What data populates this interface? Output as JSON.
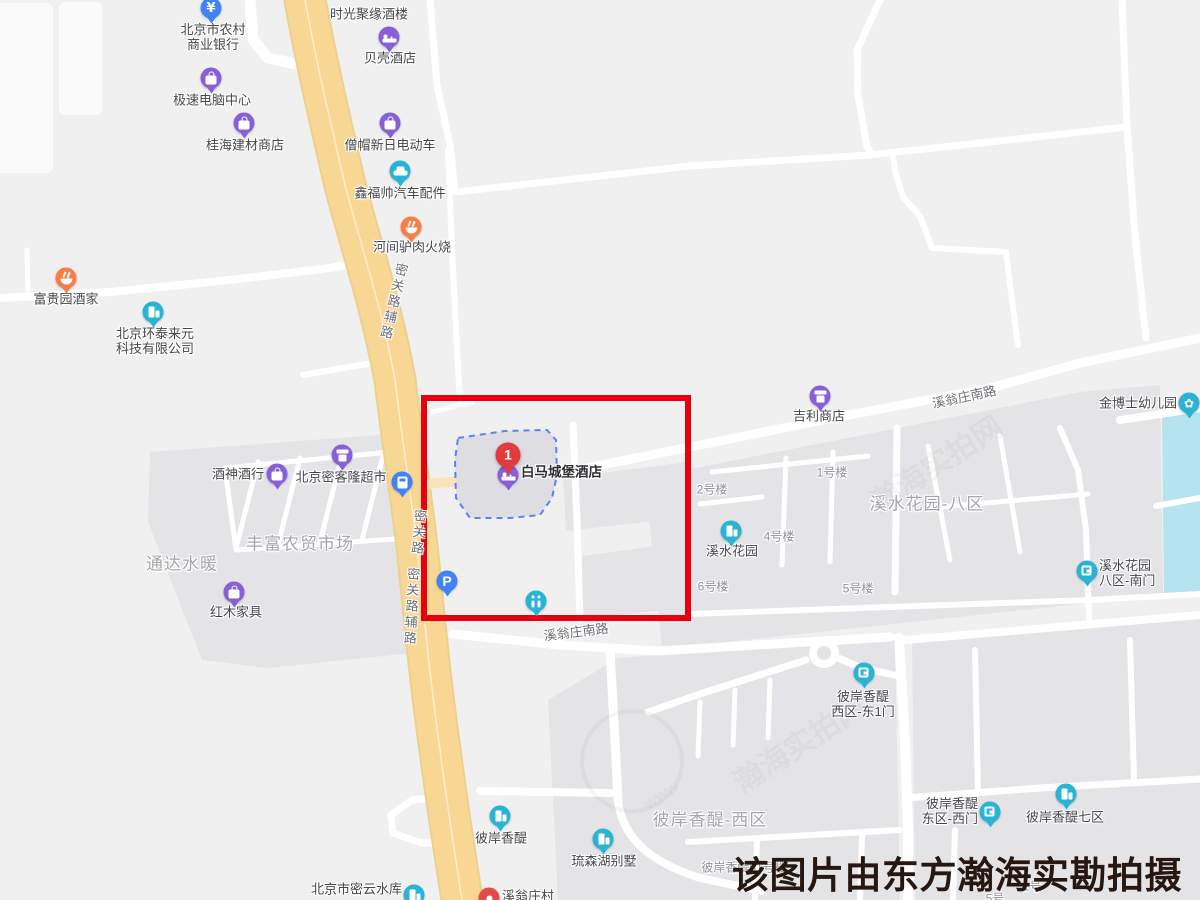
{
  "caption": {
    "text": "该图片由东方瀚海实勘拍摄"
  },
  "marker": {
    "number": "1",
    "x": 508,
    "y": 455,
    "for_poi": "白马城堡酒店",
    "color": "#e23b3e"
  },
  "highlight_box": {
    "x": 424,
    "y": 398,
    "width": 264,
    "height": 220,
    "color": "#e60012"
  },
  "colors": {
    "background": "#f0f0f1",
    "block": "#e4e4e7",
    "water": "#b6e3f0",
    "road_major": "#f8d795",
    "road_minor": "#ffffff",
    "poi_purple": "#8760d8",
    "poi_blue": "#3f83f7",
    "poi_teal": "#29b4d6",
    "poi_orange": "#f97d45",
    "poi_red": "#e34a4a"
  },
  "pois": [
    {
      "id": "shiguangjuyuan",
      "icon": "none",
      "color": "",
      "x": 369,
      "y": -14,
      "lines": [
        "时光聚缘酒楼"
      ],
      "pos": "center",
      "lx": 369,
      "ly": 14
    },
    {
      "id": "rural-bank",
      "icon": "bank",
      "color": "#3f83f7",
      "x": 211,
      "y": 8,
      "lines": [
        "北京市农村",
        "商业银行"
      ],
      "pos": "below",
      "lx": 213,
      "ly": 37
    },
    {
      "id": "beike-hotel",
      "icon": "hotel",
      "color": "#8760d8",
      "x": 389,
      "y": 37,
      "lines": [
        "贝壳酒店"
      ],
      "pos": "below",
      "lx": 390,
      "ly": 58
    },
    {
      "id": "jisu-computer",
      "icon": "bag",
      "color": "#8760d8",
      "x": 211,
      "y": 78,
      "lines": [
        "极速电脑中心"
      ],
      "pos": "below",
      "lx": 212,
      "ly": 100
    },
    {
      "id": "guihai-building-materials",
      "icon": "bag",
      "color": "#8760d8",
      "x": 244,
      "y": 123,
      "lines": [
        "桂海建材商店"
      ],
      "pos": "below",
      "lx": 245,
      "ly": 145
    },
    {
      "id": "sengmao-ebike",
      "icon": "bag",
      "color": "#8760d8",
      "x": 390,
      "y": 123,
      "lines": [
        "僧帽新日电动车"
      ],
      "pos": "below",
      "lx": 390,
      "ly": 145
    },
    {
      "id": "xinfushuai-auto-parts",
      "icon": "car",
      "color": "#29b4d6",
      "x": 400,
      "y": 171,
      "lines": [
        "鑫福帅汽车配件"
      ],
      "pos": "below",
      "lx": 400,
      "ly": 193
    },
    {
      "id": "hejian-donkey-burger",
      "icon": "restaurant",
      "color": "#f97d45",
      "x": 411,
      "y": 227,
      "lines": [
        "河间驴肉火烧"
      ],
      "pos": "below",
      "lx": 412,
      "ly": 247
    },
    {
      "id": "fuguiyuan-restaurant",
      "icon": "restaurant",
      "color": "#f97d45",
      "x": 66,
      "y": 278,
      "lines": [
        "富贵园酒家"
      ],
      "pos": "below",
      "lx": 66,
      "ly": 299
    },
    {
      "id": "huantai-laiyuan-tech",
      "icon": "building",
      "color": "#29b4d6",
      "x": 153,
      "y": 312,
      "lines": [
        "北京环泰来元",
        "科技有限公司"
      ],
      "pos": "below",
      "lx": 155,
      "ly": 341
    },
    {
      "id": "jiushen-liquor",
      "icon": "bag",
      "color": "#8760d8",
      "x": 277,
      "y": 474,
      "lines": [
        "酒神酒行"
      ],
      "pos": "left",
      "lx": 264,
      "ly": 474
    },
    {
      "id": "mikelong-supermarket",
      "icon": "market",
      "color": "#8760d8",
      "x": 342,
      "y": 455,
      "lines": [
        "北京密客隆超市"
      ],
      "pos": "below",
      "lx": 341,
      "ly": 477
    },
    {
      "id": "bus-stop",
      "icon": "bus",
      "color": "#3f83f7",
      "x": 402,
      "y": 482,
      "lines": [],
      "pos": "below",
      "lx": 402,
      "ly": 500
    },
    {
      "id": "hongmu-furniture",
      "icon": "bag",
      "color": "#8760d8",
      "x": 234,
      "y": 592,
      "lines": [
        "红木家具"
      ],
      "pos": "below",
      "lx": 236,
      "ly": 612
    },
    {
      "id": "baima-castle-hotel",
      "icon": "hotel",
      "color": "#8760d8",
      "x": 508,
      "y": 475,
      "lines": [
        "白马城堡酒店"
      ],
      "pos": "right",
      "lx": 521,
      "ly": 472,
      "selected": true
    },
    {
      "id": "parking",
      "icon": "parking",
      "color": "#3f83f7",
      "x": 447,
      "y": 581,
      "lines": [],
      "pos": "below",
      "lx": 447,
      "ly": 600
    },
    {
      "id": "toilet",
      "icon": "toilet",
      "color": "#29b4d6",
      "x": 536,
      "y": 601,
      "lines": [],
      "pos": "below",
      "lx": 536,
      "ly": 620
    },
    {
      "id": "jili-store",
      "icon": "market",
      "color": "#8760d8",
      "x": 820,
      "y": 396,
      "lines": [
        "吉利商店"
      ],
      "pos": "below",
      "lx": 819,
      "ly": 416
    },
    {
      "id": "jinboshi-kindergarten",
      "icon": "kindergarten",
      "color": "#29b4d6",
      "x": 1189,
      "y": 403,
      "lines": [
        "金博士幼儿园"
      ],
      "pos": "left",
      "lx": 1177,
      "ly": 403
    },
    {
      "id": "xishui-garden",
      "icon": "building",
      "color": "#29b4d6",
      "x": 731,
      "y": 531,
      "lines": [
        "溪水花园"
      ],
      "pos": "below",
      "lx": 732,
      "ly": 551
    },
    {
      "id": "xishui-8qu-south-gate",
      "icon": "gate",
      "color": "#29b4d6",
      "x": 1087,
      "y": 571,
      "lines": [
        "溪水花园",
        "八区-南门"
      ],
      "pos": "right",
      "lx": 1099,
      "ly": 573
    },
    {
      "id": "bianxiangti-west-east-gate1",
      "icon": "gate",
      "color": "#29b4d6",
      "x": 864,
      "y": 673,
      "lines": [
        "彼岸香醍",
        "西区-东1门"
      ],
      "pos": "below",
      "lx": 863,
      "ly": 704
    },
    {
      "id": "bianxiangti-east-west-gate",
      "icon": "gate",
      "color": "#29b4d6",
      "x": 990,
      "y": 812,
      "lines": [
        "彼岸香醍",
        "东区-西门"
      ],
      "pos": "left",
      "lx": 978,
      "ly": 811
    },
    {
      "id": "bianxiangti-7qu",
      "icon": "building",
      "color": "#29b4d6",
      "x": 1066,
      "y": 794,
      "lines": [
        "彼岸香醍七区"
      ],
      "pos": "below",
      "lx": 1065,
      "ly": 817
    },
    {
      "id": "bianxiangti",
      "icon": "building",
      "color": "#29b4d6",
      "x": 500,
      "y": 816,
      "lines": [
        "彼岸香醍"
      ],
      "pos": "below",
      "lx": 501,
      "ly": 838
    },
    {
      "id": "liusenhu-villa",
      "icon": "building",
      "color": "#29b4d6",
      "x": 603,
      "y": 839,
      "lines": [
        "琉森湖别墅"
      ],
      "pos": "below",
      "lx": 604,
      "ly": 861
    },
    {
      "id": "miyun-reservoir",
      "icon": "building",
      "color": "#29b4d6",
      "x": 414,
      "y": 895,
      "lines": [
        "北京市密云水库"
      ],
      "pos": "left",
      "lx": 402,
      "ly": 889
    },
    {
      "id": "xiwengzhuang-village",
      "icon": "village",
      "color": "#e34a4a",
      "x": 489,
      "y": 898,
      "lines": [
        "溪翁庄村"
      ],
      "pos": "right",
      "lx": 502,
      "ly": 896
    }
  ],
  "area_labels": [
    {
      "id": "fengfu-market",
      "text": "丰富农贸市场",
      "x": 300,
      "y": 542
    },
    {
      "id": "tongda-shuinuan",
      "text": "通达水暖",
      "x": 182,
      "y": 562
    },
    {
      "id": "xishui-garden-8qu",
      "text": "溪水花园-八区",
      "x": 927,
      "y": 502
    },
    {
      "id": "bianxiangti-west-area",
      "text": "彼岸香醍-西区",
      "x": 710,
      "y": 818
    }
  ],
  "building_labels": [
    {
      "id": "b1",
      "text": "1号楼",
      "x": 832,
      "y": 472
    },
    {
      "id": "b2",
      "text": "2号楼",
      "x": 712,
      "y": 489
    },
    {
      "id": "b4",
      "text": "4号楼",
      "x": 779,
      "y": 536
    },
    {
      "id": "b6",
      "text": "6号楼",
      "x": 713,
      "y": 586
    },
    {
      "id": "b5",
      "text": "5号楼",
      "x": 858,
      "y": 588
    },
    {
      "id": "b51",
      "text": "彼岸香醍51号楼",
      "x": 744,
      "y": 867
    },
    {
      "id": "b1h",
      "text": "1号",
      "x": 1032,
      "y": 886
    },
    {
      "id": "b5h",
      "text": "5号",
      "x": 995,
      "y": 898
    }
  ],
  "road_labels": [
    {
      "id": "miguanlu-fulu-top",
      "text": "密关路辅路",
      "x": 393,
      "y": 302,
      "vertical": true,
      "rot": 13
    },
    {
      "id": "miguanlu",
      "text": "密关路",
      "x": 418,
      "y": 533,
      "vertical": true,
      "rot": 5
    },
    {
      "id": "miguanlu-fulu-bottom",
      "text": "密关路辅路",
      "x": 411,
      "y": 607,
      "vertical": true,
      "rot": 3
    },
    {
      "id": "xiwengzhuang-nanlu-ne",
      "text": "溪翁庄南路",
      "x": 964,
      "y": 396,
      "vertical": false,
      "rot": -12
    },
    {
      "id": "xiwengzhuang-nanlu-sw",
      "text": "溪翁庄南路",
      "x": 576,
      "y": 631,
      "vertical": false,
      "rot": -7
    }
  ],
  "watermark": {
    "texts": [
      {
        "t": "瀚海实拍网",
        "x": 935,
        "y": 462,
        "rot": -33,
        "size": 30
      },
      {
        "t": "瀚海实拍网",
        "x": 798,
        "y": 742,
        "rot": -33,
        "size": 30
      },
      {
        "t": "www",
        "x": 662,
        "y": 796,
        "rot": -33,
        "size": 16
      }
    ],
    "ring": {
      "x": 628,
      "y": 757,
      "r": 48
    }
  }
}
